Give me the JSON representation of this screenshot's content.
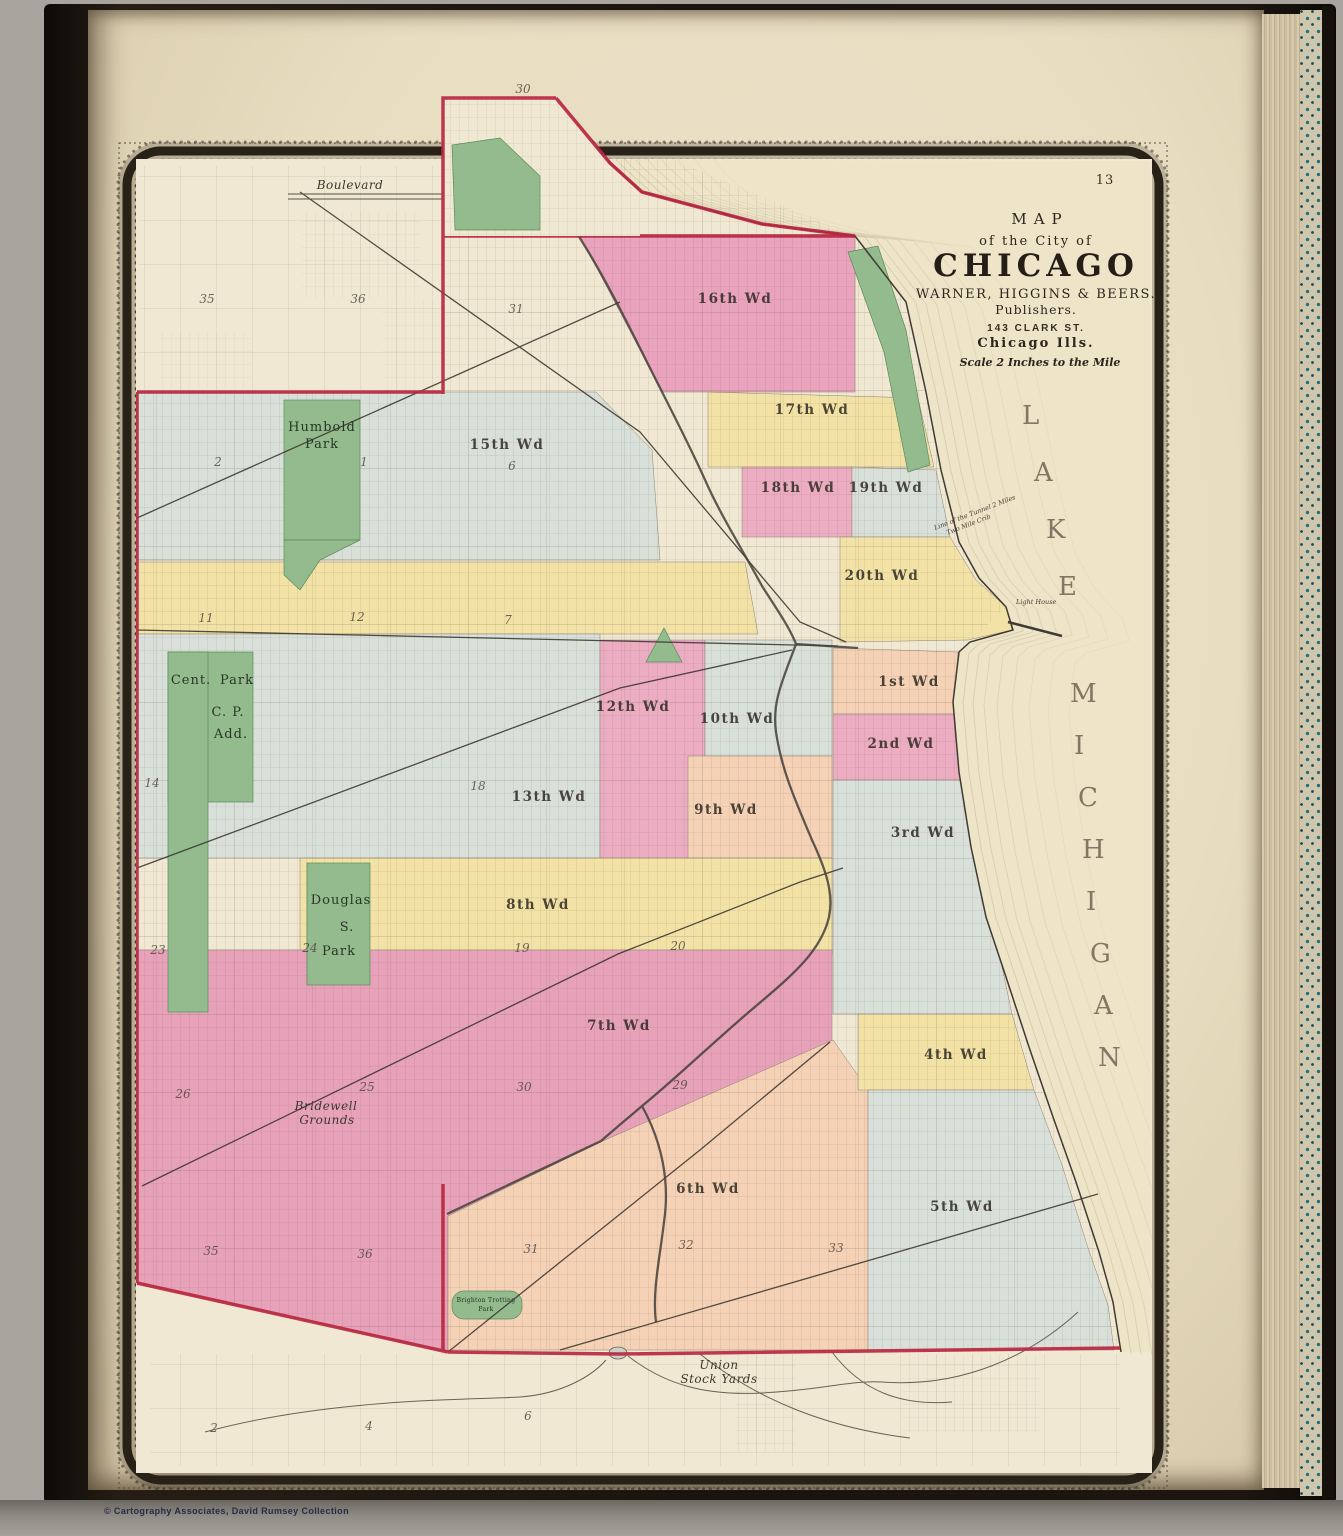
{
  "page": {
    "number": "13"
  },
  "credit": "© Cartography Associates, David Rumsey Collection",
  "title_block": {
    "line_map": "MAP",
    "line_of": "of the City of",
    "line_city": "CHICAGO",
    "line_publisher": "WARNER, HIGGINS & BEERS.",
    "line_publishers": "Publishers.",
    "line_address": "143 CLARK ST.",
    "line_citystate": "Chicago  Ills.",
    "line_scale": "Scale 2 Inches to the Mile"
  },
  "lake": {
    "word1": "LAKE",
    "word2": "MICHIGAN"
  },
  "annotations": {
    "boulevard": "Boulevard",
    "tunnel_line1": "Line of the Tunnel 2 Miles",
    "tunnel_line2": "Two Mile Crib",
    "lighthouse": "Light House"
  },
  "wards": [
    {
      "label": "15th Wd"
    },
    {
      "label": "16th Wd"
    },
    {
      "label": "17th Wd"
    },
    {
      "label": "18th Wd"
    },
    {
      "label": "19th Wd"
    },
    {
      "label": "20th Wd"
    },
    {
      "label": "12th Wd"
    },
    {
      "label": "10th Wd"
    },
    {
      "label": "13th Wd"
    },
    {
      "label": "9th Wd"
    },
    {
      "label": "8th Wd"
    },
    {
      "label": "7th Wd"
    },
    {
      "label": "6th Wd"
    },
    {
      "label": "1st Wd"
    },
    {
      "label": "2nd Wd"
    },
    {
      "label": "3rd Wd"
    },
    {
      "label": "4th Wd"
    },
    {
      "label": "5th Wd"
    }
  ],
  "parks": {
    "humboldt1": "Humbold",
    "humboldt2": "Park",
    "central1": "Cent.",
    "central2": "Park",
    "central3": "C. P.",
    "central4": "Add.",
    "douglas1": "Douglas",
    "douglas2": "S.",
    "douglas3": "Park",
    "brighton1": "Brighton Trotting",
    "brighton2": "Park"
  },
  "places": {
    "bridewell1": "Bridewell",
    "bridewell2": "Grounds",
    "stockyards1": "Union",
    "stockyards2": "Stock Yards"
  },
  "sections": {
    "s30t": "30",
    "s35a": "35",
    "s36a": "36",
    "s31a": "31",
    "s2": "2",
    "s1": "1",
    "s6": "6",
    "s11": "11",
    "s12": "12",
    "s7": "7",
    "s14": "14",
    "s18": "18",
    "s23": "23",
    "s24": "24",
    "s19": "19",
    "s20": "20",
    "s26": "26",
    "s25": "25",
    "s30b": "30",
    "s29": "29",
    "s35b": "35",
    "s36b": "36",
    "s31b": "31",
    "s32": "32",
    "s33": "33",
    "b2": "2",
    "b4": "4",
    "b6": "6"
  }
}
